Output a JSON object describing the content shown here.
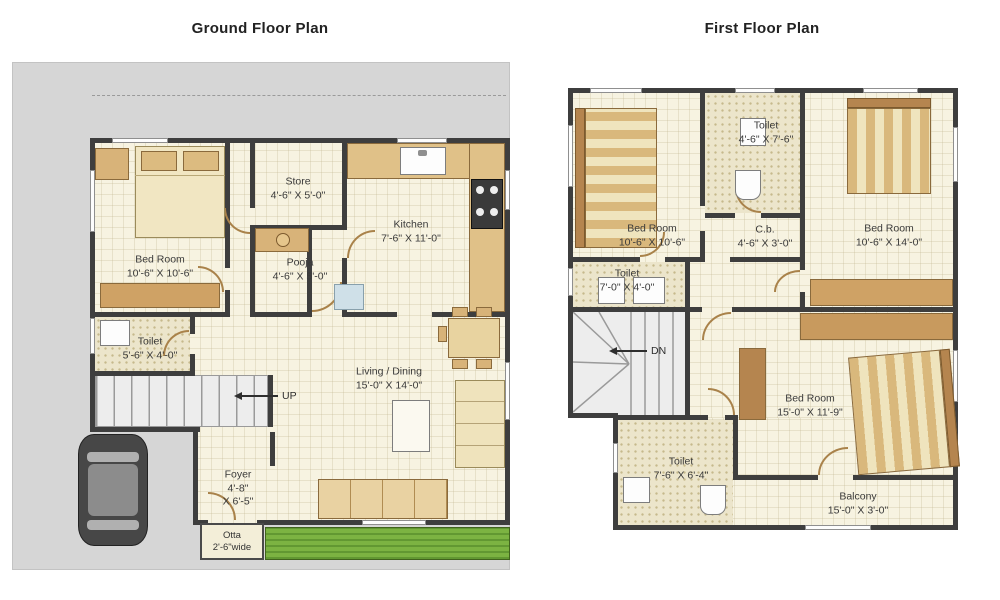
{
  "titles": {
    "ground": "Ground Floor Plan",
    "first": "First Floor Plan"
  },
  "ground_floor": {
    "bedroom": {
      "name": "Bed Room",
      "dims": "10'-6\" X 10'-6\""
    },
    "store": {
      "name": "Store",
      "dims": "4'-6\" X 5'-0\""
    },
    "pooja": {
      "name": "Pooja",
      "dims": "4'-6\" X 5'-0\""
    },
    "kitchen": {
      "name": "Kitchen",
      "dims": "7'-6\" X 11'-0\""
    },
    "toilet": {
      "name": "Toilet",
      "dims": "5'-6\" X 4'-0\""
    },
    "living": {
      "name": "Living / Dining",
      "dims": "15'-0\" X 14'-0\""
    },
    "foyer": {
      "name": "Foyer",
      "dims1": "4'-8\"",
      "dims2": "X 6'-5\""
    },
    "otta": {
      "name": "Otta",
      "dims": "2'-6\"wide"
    },
    "stairs": {
      "label": "UP"
    }
  },
  "first_floor": {
    "bedroom_top_left": {
      "name": "Bed Room",
      "dims": "10'-6\" X 10'-6\""
    },
    "toilet_top": {
      "name": "Toilet",
      "dims": "4'-6\" X 7'-6\""
    },
    "bedroom_right": {
      "name": "Bed Room",
      "dims": "10'-6\" X 14'-0\""
    },
    "cupboard": {
      "name": "C.b.",
      "dims": "4'-6\" X 3'-0\""
    },
    "toilet_mid": {
      "name": "Toilet",
      "dims": "7'-0\" X 4'-0\""
    },
    "bedroom_bottom": {
      "name": "Bed Room",
      "dims": "15'-0\" X 11'-9\""
    },
    "toilet_bottom": {
      "name": "Toilet",
      "dims": "7'-6\" X 6'-4\""
    },
    "balcony": {
      "name": "Balcony",
      "dims": "15'-0\" X 3'-0\""
    },
    "stairs": {
      "label": "DN"
    }
  },
  "colors": {
    "wall": "#3e3e3e",
    "floor": "#f7f3e1",
    "plot": "#d6d6d6",
    "wood": "#d8b379",
    "grass": "#7cb342"
  }
}
